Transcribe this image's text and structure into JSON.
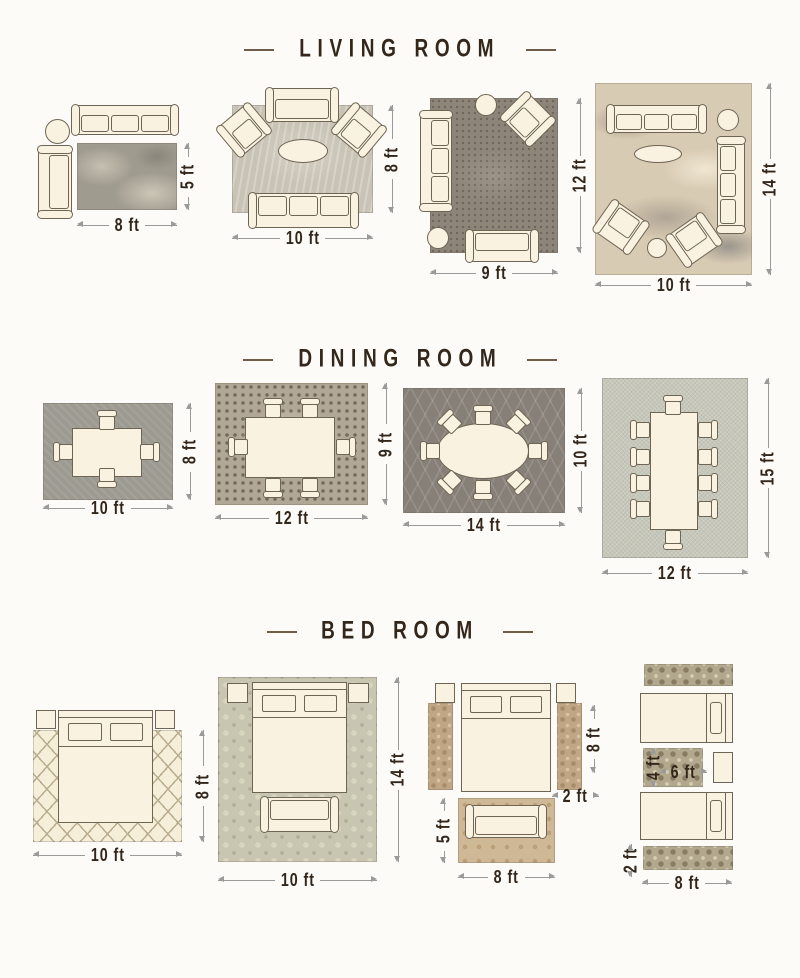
{
  "palette": {
    "background": "#fcfbf8",
    "furniture_fill": "#f9f2e1",
    "furniture_outline": "#6f6554",
    "dimension_line": "#9a9a9a",
    "label_text": "#33261a",
    "header_text": "#33261a"
  },
  "sections": [
    {
      "title": "LIVING ROOM",
      "layouts": [
        {
          "name": "8x5",
          "rug_color": "#a09b8f",
          "width_label": "8 ft",
          "height_label": "5 ft"
        },
        {
          "name": "10x8",
          "rug_color": "#c9c3b6",
          "width_label": "10 ft",
          "height_label": "8 ft"
        },
        {
          "name": "9x12",
          "rug_color": "#8d8579",
          "width_label": "9 ft",
          "height_label": "12 ft"
        },
        {
          "name": "10x14",
          "rug_color": "#d8cbb3",
          "width_label": "10 ft",
          "height_label": "14 ft"
        }
      ]
    },
    {
      "title": "DINING ROOM",
      "layouts": [
        {
          "name": "10x8",
          "rug_color": "#9d9a92",
          "width_label": "10 ft",
          "height_label": "8 ft"
        },
        {
          "name": "12x9",
          "rug_color": "#b0a795",
          "width_label": "12 ft",
          "height_label": "9 ft"
        },
        {
          "name": "14x10",
          "rug_color": "#878078",
          "width_label": "14 ft",
          "height_label": "10 ft"
        },
        {
          "name": "12x15",
          "rug_color": "#c6c7b9",
          "width_label": "12 ft",
          "height_label": "15 ft"
        }
      ]
    },
    {
      "title": "BED ROOM",
      "layouts": [
        {
          "name": "10x8",
          "rug_color": "#f5eed9",
          "width_label": "10 ft",
          "height_label": "8 ft"
        },
        {
          "name": "10x14",
          "rug_color": "#c8c6b0",
          "width_label": "10 ft",
          "height_label": "14 ft"
        },
        {
          "name": "runners-and-foot-rug",
          "runner_color": "#c0a685",
          "rug_color": "#cfb896",
          "runner_height_label": "8 ft",
          "runner_width_label": "2 ft",
          "foot_rug_height_label": "5 ft",
          "foot_rug_width_label": "8 ft"
        },
        {
          "name": "twin-beds-runners",
          "rug_color": "#b2a88e",
          "middle_rug_height_label": "4 ft",
          "middle_rug_width_label": "6 ft",
          "runner_height_label": "2 ft",
          "runner_width_label": "8 ft"
        }
      ]
    }
  ]
}
